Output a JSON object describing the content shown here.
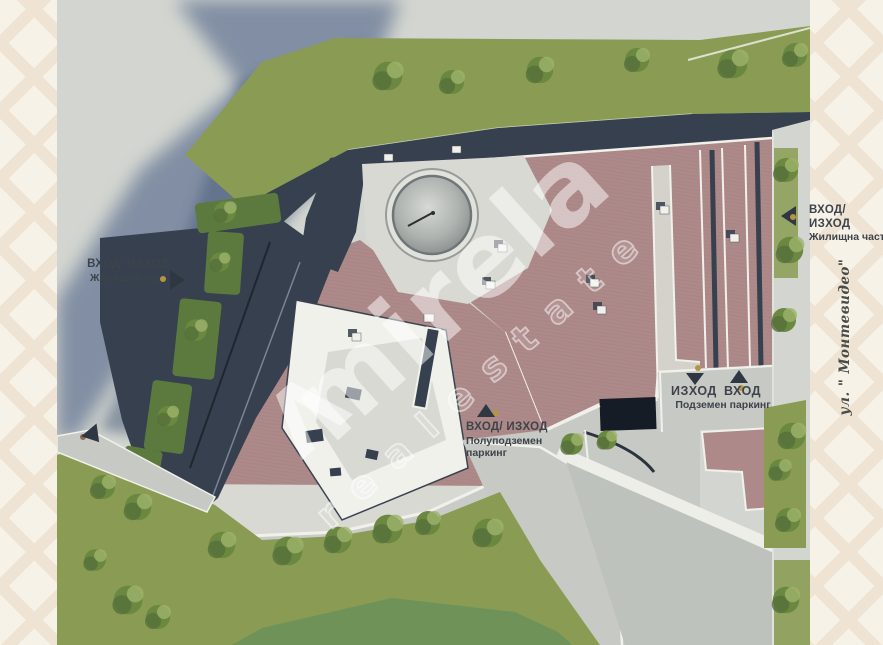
{
  "palette": {
    "margin_bg": "#f7f2e7",
    "margin_line": "#efe4d4",
    "pavement": "#d3d6d0",
    "pavement_dark": "#bec2bc",
    "concrete": "#d9d9d3",
    "road": "#c7cac4",
    "shadow": "#5f7191",
    "shadow_dark": "#4e5f7d",
    "navy": "#36404f",
    "navy_deep": "#222b37",
    "roof": "#ad8a89",
    "white_surface": "#f1f1ec",
    "lawn": "#8a9c54",
    "lawn_dark": "#6e9258",
    "hedge": "#5d7a3e",
    "tree": "#6b8840",
    "tree_dark": "#55703a",
    "tree_light": "#9db36a",
    "dome": "#b5b8b4",
    "tunnel": "#161c25",
    "label": "#3d434b",
    "arrow": "#2e3742",
    "dot_gold": "#b5953f",
    "dot_brown": "#8a6b4f",
    "street_text": "#4a4a46",
    "watermark": "rgba(255,255,255,0.5)"
  },
  "watermark": {
    "brand": "mirela",
    "tagline": "realestate",
    "logo_glyph": "Λ"
  },
  "street_label": "ул. \" Монтевидео\"",
  "markers": {
    "residential_left": {
      "line1": "ВХОД/ ИЗХОД",
      "line2": "Жилищна част"
    },
    "residential_right": {
      "line1": "ВХОД/ ИЗХОД",
      "line2": "Жилищна част"
    },
    "semi_underground_parking": {
      "line1": "ВХОД/ ИЗХОД",
      "line2": "Полуподземен",
      "line3": "паркинг"
    },
    "underground_parking": {
      "exit": "ИЗХОД",
      "entrance": "ВХОД",
      "caption": "Подземен паркинг"
    }
  }
}
